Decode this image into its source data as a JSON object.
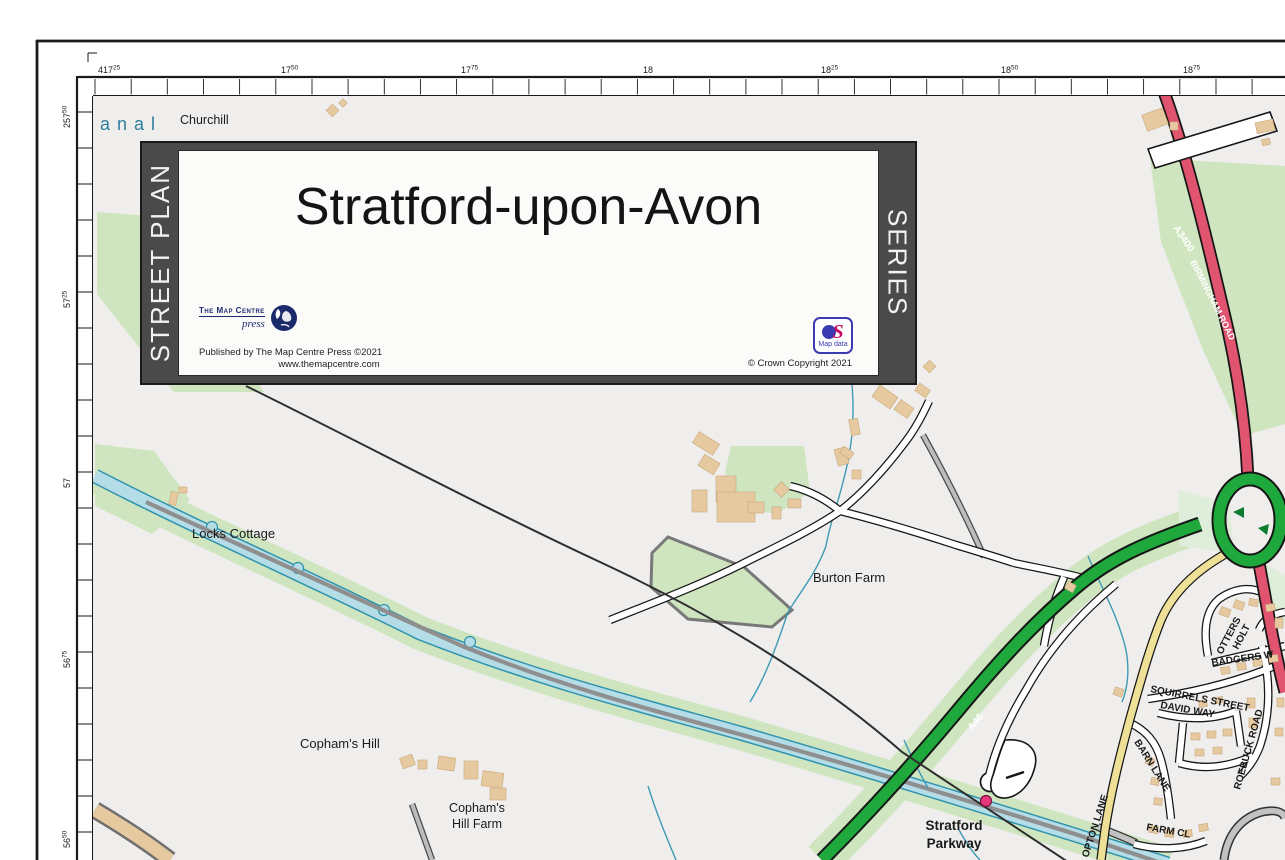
{
  "banner": {
    "left_bar": "STREET PLAN",
    "right_bar": "SERIES",
    "title": "Stratford-upon-Avon",
    "publisher_logo": {
      "name_line": "The Map Centre",
      "sub_line": "press"
    },
    "published_line1": "Published by The Map Centre Press ©2021",
    "published_line2": "www.themapcentre.com",
    "os_logo": {
      "s": "S",
      "caption": "Map data"
    },
    "crown_copyright": "© Crown Copyright 2021"
  },
  "grid": {
    "top_labels": [
      {
        "main": "417",
        "sup": "25",
        "x": 96
      },
      {
        "main": "17",
        "sup": "50",
        "x": 279
      },
      {
        "main": "17",
        "sup": "75",
        "x": 459
      },
      {
        "main": "18",
        "sup": "",
        "x": 641
      },
      {
        "main": "18",
        "sup": "25",
        "x": 819
      },
      {
        "main": "18",
        "sup": "50",
        "x": 999
      },
      {
        "main": "18",
        "sup": "75",
        "x": 1181
      }
    ],
    "left_labels": [
      {
        "main": "257",
        "sup": "50",
        "y": 112
      },
      {
        "main": "57",
        "sup": "25",
        "y": 292
      },
      {
        "main": "57",
        "sup": "",
        "y": 472
      },
      {
        "main": "56",
        "sup": "75",
        "y": 652
      },
      {
        "main": "56",
        "sup": "50",
        "y": 832
      }
    ]
  },
  "map": {
    "colors": {
      "background": "#efeeec",
      "green": "#cfe5c0",
      "pale_green": "#dfeeda",
      "canal_fill": "#b5dde8",
      "canal_edge": "#2f93ad",
      "road_casing": "#161616",
      "a_road_green": "#1fa83c",
      "a_road_red": "#e0546f",
      "b_road_yellow": "#efe098",
      "building": "#e7c9a0",
      "railway": "#2e2e2e",
      "station": "#e8387d",
      "canal_label": "#2f7e9c",
      "label": "#1a1a1a"
    },
    "labels": [
      {
        "text": "anal",
        "x": 100,
        "y": 130,
        "size": 18,
        "color": "#2f7e9c",
        "ls": 7
      },
      {
        "text": "Churchill",
        "x": 180,
        "y": 124,
        "size": 12.5
      },
      {
        "text": "Locks Cottage",
        "x": 192,
        "y": 538,
        "size": 13
      },
      {
        "text": "Burton Farm",
        "x": 813,
        "y": 582,
        "size": 13
      },
      {
        "text": "Copham's Hill",
        "x": 300,
        "y": 748,
        "size": 13
      },
      {
        "text": "Copham's",
        "x": 477,
        "y": 812,
        "size": 12.5,
        "anchor": "middle"
      },
      {
        "text": "Hill Farm",
        "x": 477,
        "y": 828,
        "size": 12.5,
        "anchor": "middle"
      },
      {
        "text": "Stratford",
        "x": 954,
        "y": 830,
        "size": 13.5,
        "weight": 700,
        "anchor": "middle"
      },
      {
        "text": "Parkway",
        "x": 954,
        "y": 848,
        "size": 13.5,
        "weight": 700,
        "anchor": "middle"
      },
      {
        "text": "OTTERS",
        "x": 1222,
        "y": 655,
        "size": 10,
        "rot": -62,
        "weight": 600
      },
      {
        "text": "HOLT",
        "x": 1238,
        "y": 650,
        "size": 10,
        "rot": -62,
        "weight": 600
      },
      {
        "text": "BADGERS W",
        "x": 1212,
        "y": 666,
        "size": 10,
        "rot": -8,
        "weight": 600
      },
      {
        "text": "SQUIRRELS STREET",
        "x": 1150,
        "y": 692,
        "size": 10,
        "rot": 11,
        "weight": 600
      },
      {
        "text": "DAVID WAY",
        "x": 1160,
        "y": 708,
        "size": 10,
        "rot": 10,
        "weight": 600
      },
      {
        "text": "ROEBUCK ROAD",
        "x": 1240,
        "y": 790,
        "size": 10,
        "rot": -74,
        "weight": 600
      },
      {
        "text": "BARN LANE",
        "x": 1134,
        "y": 742,
        "size": 10,
        "rot": 58,
        "weight": 600
      },
      {
        "text": "FARM CL",
        "x": 1146,
        "y": 830,
        "size": 10,
        "rot": 10,
        "weight": 600
      },
      {
        "text": "OPTON LANE",
        "x": 1088,
        "y": 858,
        "size": 10,
        "rot": -72,
        "weight": 600
      },
      {
        "text": "A46",
        "x": 972,
        "y": 731,
        "size": 10,
        "rot": -50,
        "weight": 700,
        "color": "#ffffff"
      },
      {
        "text": "A3400",
        "x": 1173,
        "y": 228,
        "size": 10,
        "rot": 56,
        "weight": 700,
        "color": "#ffffff"
      },
      {
        "text": "BIRMINGHAM ROAD",
        "x": 1190,
        "y": 262,
        "size": 9,
        "rot": 63,
        "weight": 600,
        "color": "#ffffff"
      }
    ]
  }
}
